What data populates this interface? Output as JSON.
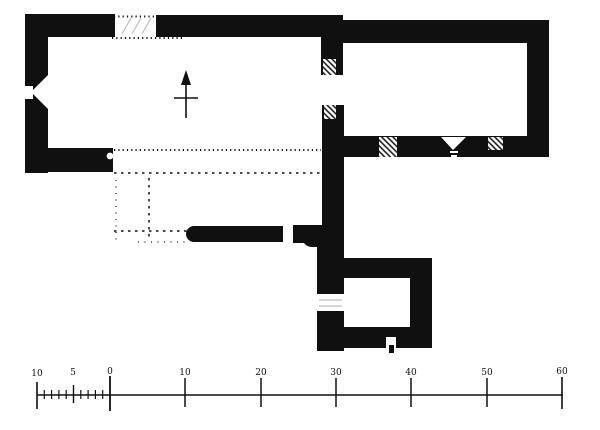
{
  "colors": {
    "ink": "#101010",
    "paper": "#ffffff",
    "faint": "#bdbdbd"
  },
  "icons": {
    "north_arrow": "↑"
  },
  "scale_bar": {
    "labels": [
      "10",
      "5",
      "0",
      "10",
      "20",
      "30",
      "40",
      "50",
      "60"
    ]
  }
}
